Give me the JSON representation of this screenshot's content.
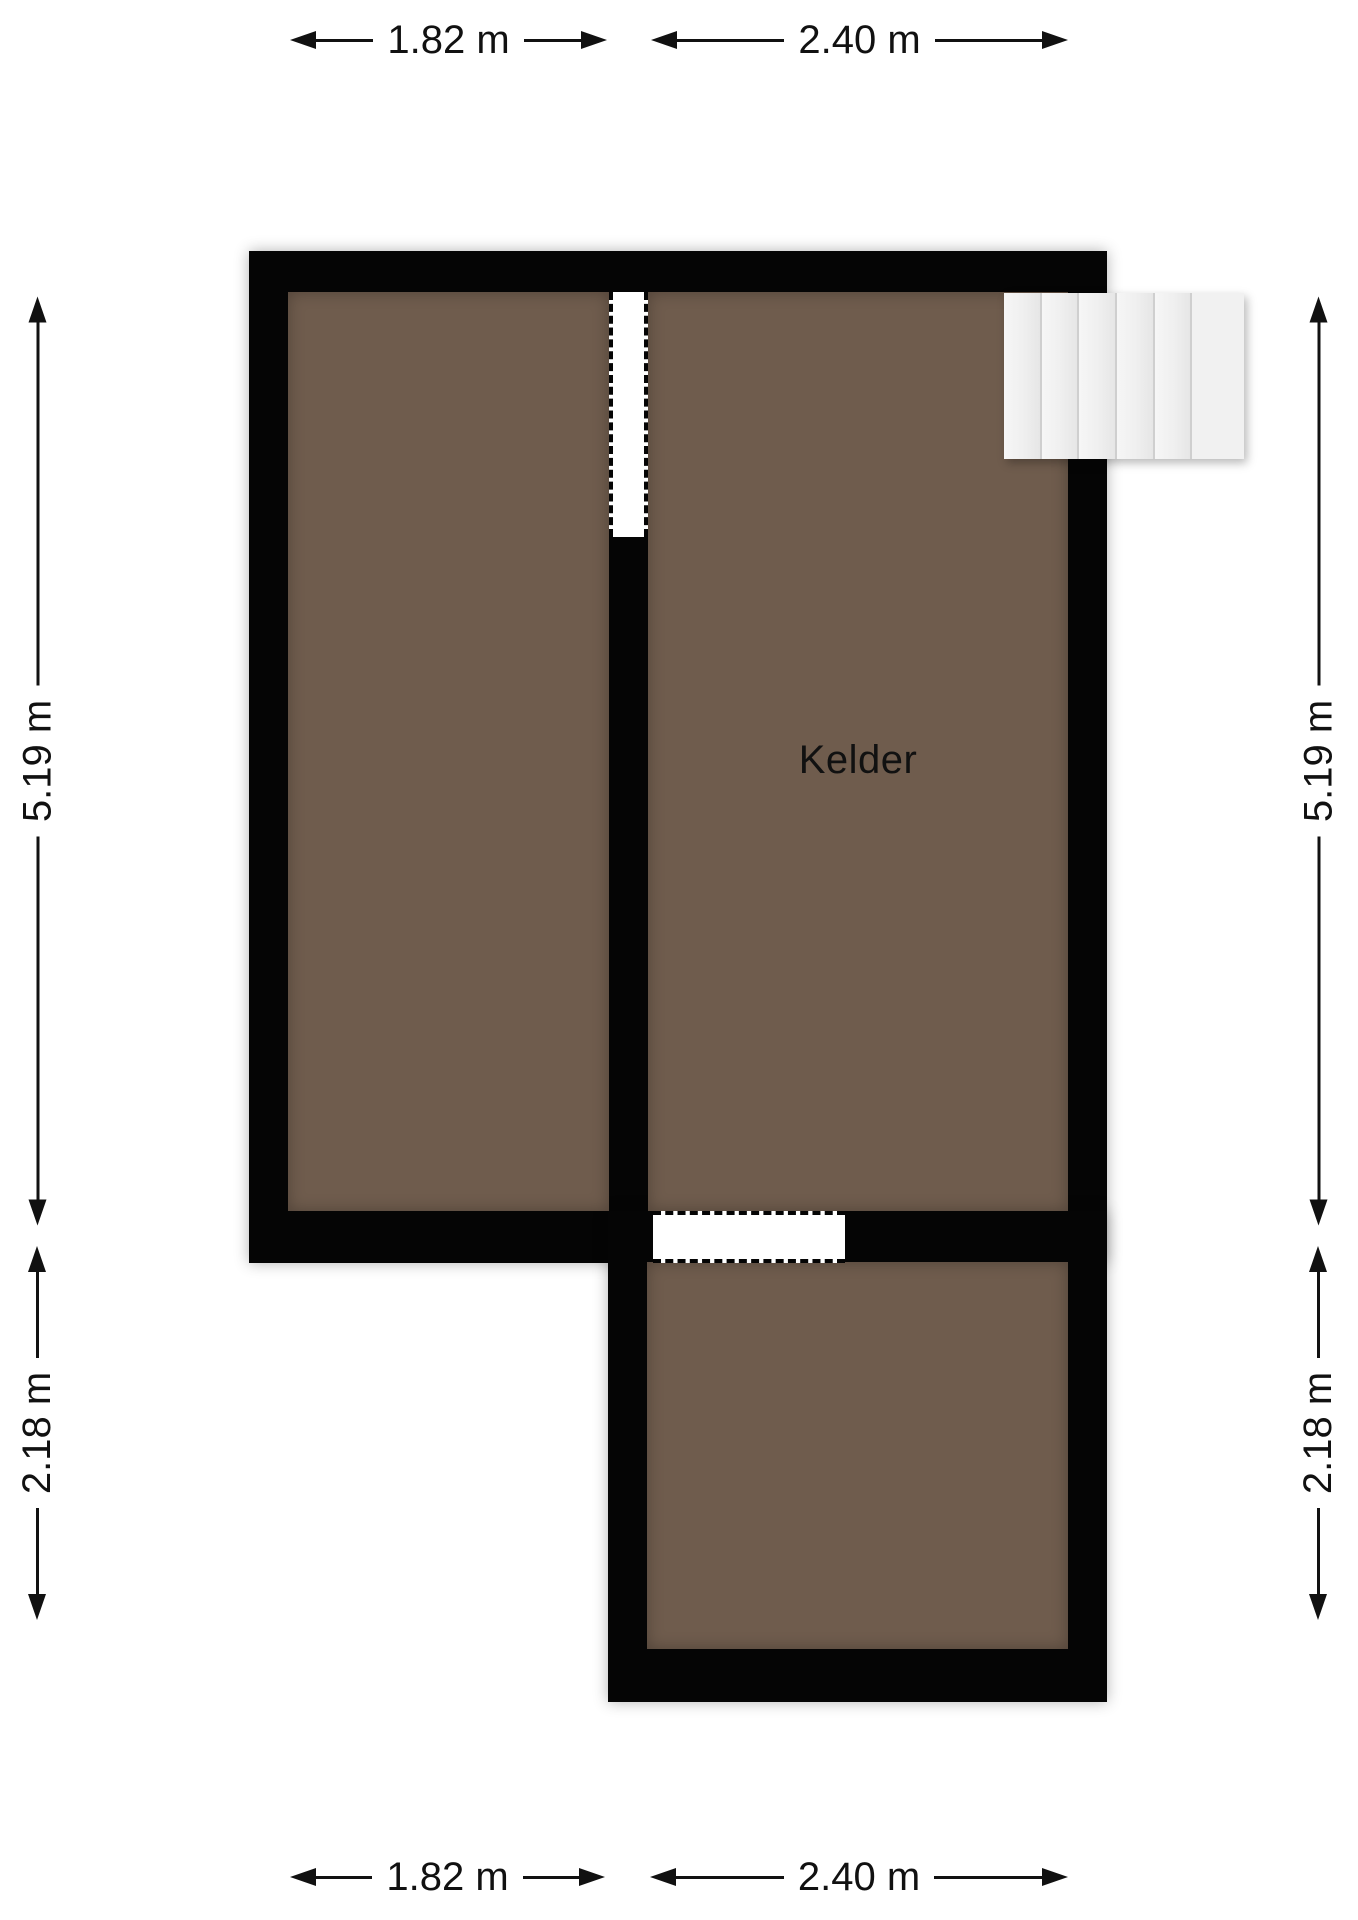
{
  "floorplan": {
    "room_label": "Kelder",
    "dimensions": {
      "top_left": "1.82 m",
      "top_right": "2.40 m",
      "bottom_left": "1.82 m",
      "bottom_right": "2.40 m",
      "left_upper": "5.19 m",
      "left_lower": "2.18 m",
      "right_upper": "5.19 m",
      "right_lower": "2.18 m"
    },
    "stairs_step_count": 6,
    "colors": {
      "wall": "#050505",
      "floor": "#6f5c4d",
      "background": "#ffffff",
      "stairs": "#f0f0f0",
      "dimension": "#111111"
    }
  }
}
